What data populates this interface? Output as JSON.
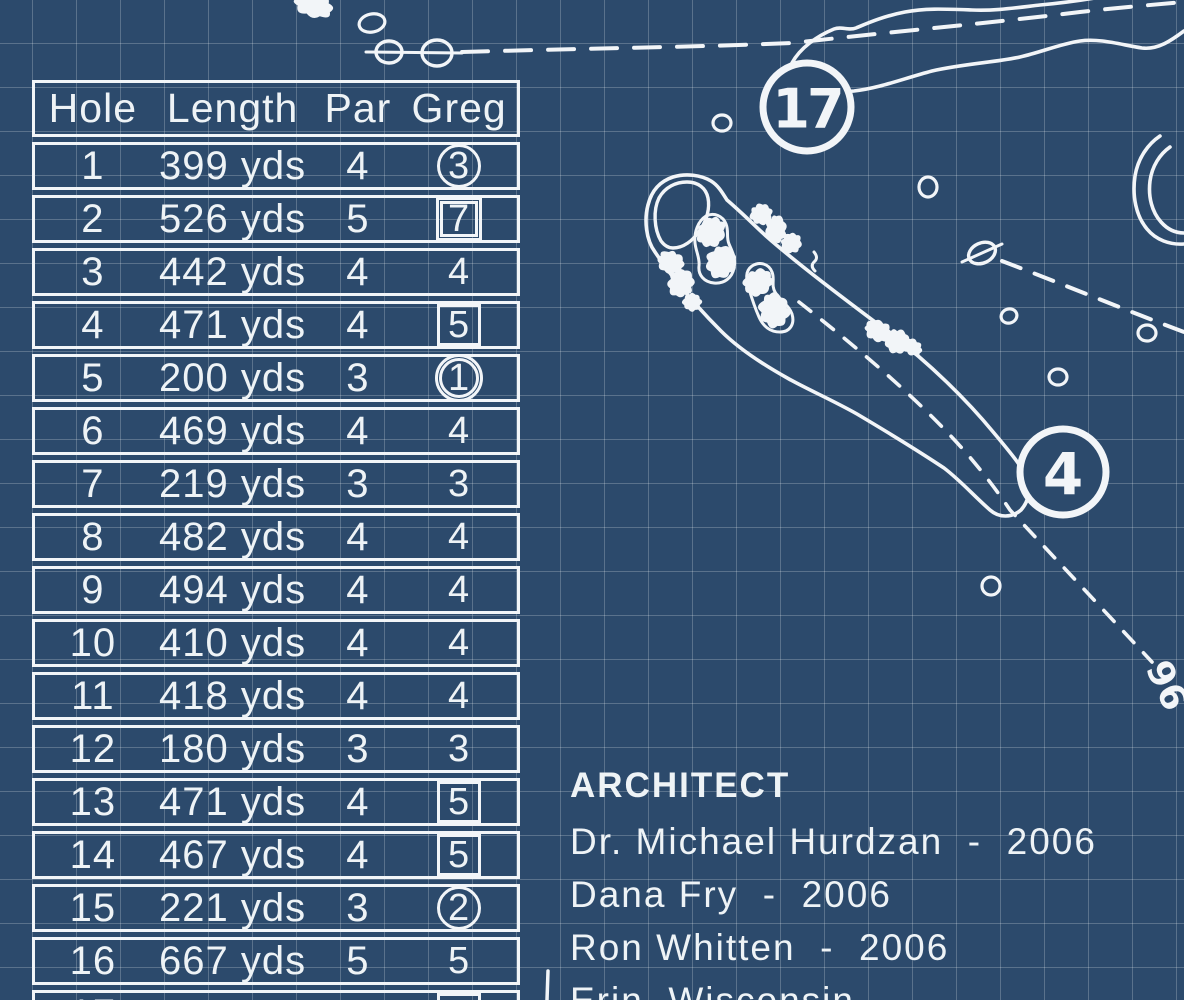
{
  "colors": {
    "background": "#2c4a6c",
    "grid_line": "#5a728c",
    "line": "#f2f5f8"
  },
  "scorecard": {
    "headers": [
      "Hole",
      "Length",
      "Par",
      "Greg"
    ],
    "rows": [
      {
        "hole": "1",
        "length": "399 yds",
        "par": "4",
        "score": "3",
        "mark": "circle"
      },
      {
        "hole": "2",
        "length": "526 yds",
        "par": "5",
        "score": "7",
        "mark": "double-square"
      },
      {
        "hole": "3",
        "length": "442 yds",
        "par": "4",
        "score": "4",
        "mark": "none"
      },
      {
        "hole": "4",
        "length": "471 yds",
        "par": "4",
        "score": "5",
        "mark": "square"
      },
      {
        "hole": "5",
        "length": "200 yds",
        "par": "3",
        "score": "1",
        "mark": "double-circle"
      },
      {
        "hole": "6",
        "length": "469 yds",
        "par": "4",
        "score": "4",
        "mark": "none"
      },
      {
        "hole": "7",
        "length": "219 yds",
        "par": "3",
        "score": "3",
        "mark": "none"
      },
      {
        "hole": "8",
        "length": "482 yds",
        "par": "4",
        "score": "4",
        "mark": "none"
      },
      {
        "hole": "9",
        "length": "494 yds",
        "par": "4",
        "score": "4",
        "mark": "none"
      },
      {
        "hole": "10",
        "length": "410 yds",
        "par": "4",
        "score": "4",
        "mark": "none"
      },
      {
        "hole": "11",
        "length": "418 yds",
        "par": "4",
        "score": "4",
        "mark": "none"
      },
      {
        "hole": "12",
        "length": "180 yds",
        "par": "3",
        "score": "3",
        "mark": "none"
      },
      {
        "hole": "13",
        "length": "471 yds",
        "par": "4",
        "score": "5",
        "mark": "square"
      },
      {
        "hole": "14",
        "length": "467 yds",
        "par": "4",
        "score": "5",
        "mark": "square"
      },
      {
        "hole": "15",
        "length": "221 yds",
        "par": "3",
        "score": "2",
        "mark": "circle"
      },
      {
        "hole": "16",
        "length": "667 yds",
        "par": "5",
        "score": "5",
        "mark": "none"
      },
      {
        "hole": "17",
        "length": "",
        "par": "",
        "score": "",
        "mark": "square"
      }
    ]
  },
  "architect": {
    "heading": "ARCHITECT",
    "lines": [
      "Dr. Michael Hurdzan  -  2006",
      "Dana Fry  -  2006",
      "Ron Whitten  -  2006",
      "Erin, Wisconsin"
    ]
  },
  "map": {
    "hole_markers": [
      {
        "number": "17"
      },
      {
        "number": "4"
      }
    ],
    "rotated_label": "96"
  }
}
